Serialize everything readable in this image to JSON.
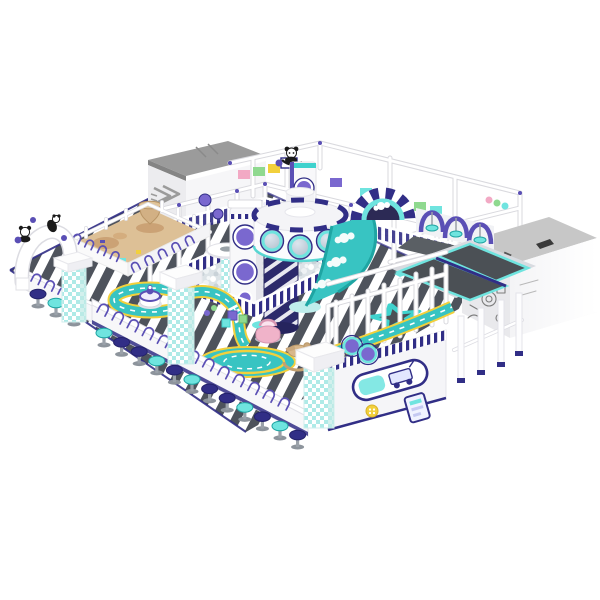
{
  "meta": {
    "description": "Isometric 3D render of a space-themed indoor soft-play playground on a white background",
    "canvas": {
      "width": 600,
      "height": 600
    }
  },
  "palette": {
    "navy": "#312e86",
    "purple": "#5a4fb5",
    "violet": "#7a68cf",
    "cyan": "#6fe4df",
    "cyanDeep": "#3fd2cd",
    "teal": "#38c4c2",
    "tealDark": "#1fa5a3",
    "yellow": "#f2d03c",
    "sand": "#ddc096",
    "sandDark": "#c3a171",
    "pink": "#f0b3c9",
    "grayRoof": "#9b9b9b",
    "grayRoofLight": "#c7c7c7",
    "wallGray": "#ececef",
    "mat": "#4b5055",
    "floorDark": "#4e535c",
    "ballBg": "#dce3e7",
    "frame": "#d9d9de"
  },
  "labels": {
    "playground": "Space themed indoor playground render",
    "floor": "Black and white striped play floor",
    "party_room_left": "Grey roofed room with arrow decal",
    "equipment_room_right": "Grey roofed room with space rover line art",
    "scaffold": "White steel play frame with purple clamps",
    "panda_topper": "Panda figure on top beam",
    "sand_pit": "Sand play pit with sand tornado sculpture",
    "entrance_arch": "White entrance arch with panda climbers",
    "ball_pit": "White ball pit with striped walls",
    "mushroom_fountain": "Mushroom ball fountain",
    "capsule_towers": "White capsule towers with porthole windows",
    "space_drum_tower": "Cylindrical space station tower with glowing portholes",
    "spiral_slide": "Dark spiral slide column",
    "wave_slide": "Teal wave slide with cloud graphics",
    "arch_tunnel": "Striped arch tunnel with cloud window",
    "swings": "Purple arch swings with cyan seats",
    "trampoline_lanes": "Trampoline lanes with cyan pads",
    "star_trampoline": "Star shaped trampoline",
    "race_track": "Teal toy-car race track with yellow edges",
    "roundabout": "Round track plaza",
    "snack_counter": "White parent counter with purple arches",
    "bar_stools": "Row of navy and cyan bar stools",
    "gingham_pillars": "Cyan gingham padded pillars",
    "picket_fence": "White picket fence",
    "toys": "Ride-on toys and soft blocks"
  },
  "counts": {
    "bar_stools": 15,
    "swing_seats": 3,
    "drum_portholes": 3,
    "gingham_pillars": 3,
    "trampoline_lanes": 2
  }
}
